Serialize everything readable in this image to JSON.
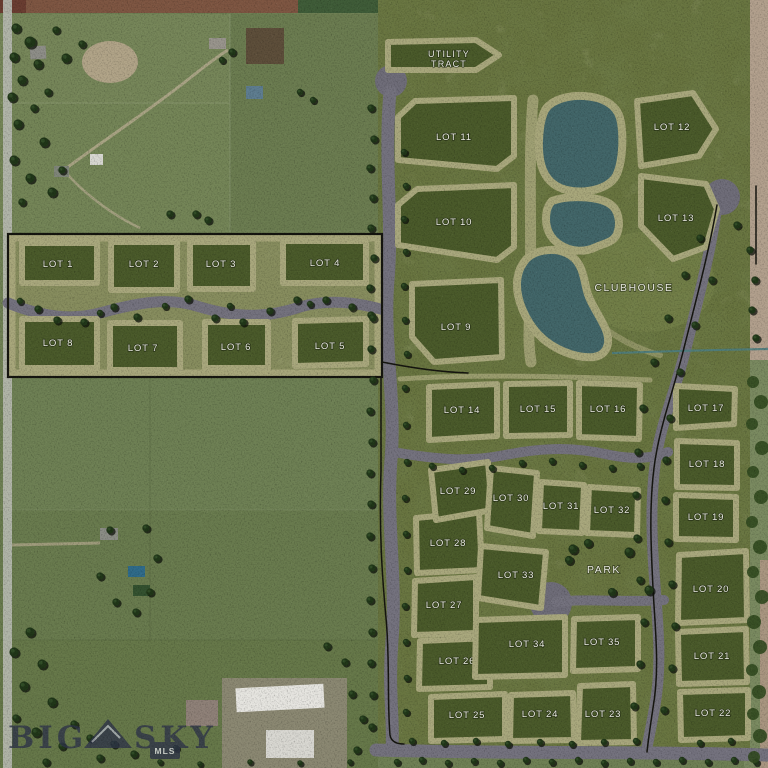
{
  "watermark": {
    "word1": "BIG",
    "word2": "SKY",
    "badge": "MLS"
  },
  "plat": {
    "utility_tract": {
      "line1": "UTILITY",
      "line2": "TRACT"
    },
    "clubhouse_label": "CLUBHOUSE",
    "park_label": "PARK",
    "lots": [
      {
        "id": 1,
        "label": "LOT 1"
      },
      {
        "id": 2,
        "label": "LOT 2"
      },
      {
        "id": 3,
        "label": "LOT 3"
      },
      {
        "id": 4,
        "label": "LOT 4"
      },
      {
        "id": 5,
        "label": "LOT 5"
      },
      {
        "id": 6,
        "label": "LOT 6"
      },
      {
        "id": 7,
        "label": "LOT 7"
      },
      {
        "id": 8,
        "label": "LOT 8"
      },
      {
        "id": 9,
        "label": "LOT 9"
      },
      {
        "id": 10,
        "label": "LOT 10"
      },
      {
        "id": 11,
        "label": "LOT 11"
      },
      {
        "id": 12,
        "label": "LOT 12"
      },
      {
        "id": 13,
        "label": "LOT 13"
      },
      {
        "id": 14,
        "label": "LOT 14"
      },
      {
        "id": 15,
        "label": "LOT 15"
      },
      {
        "id": 16,
        "label": "LOT 16"
      },
      {
        "id": 17,
        "label": "LOT 17"
      },
      {
        "id": 18,
        "label": "LOT 18"
      },
      {
        "id": 19,
        "label": "LOT 19"
      },
      {
        "id": 20,
        "label": "LOT 20"
      },
      {
        "id": 21,
        "label": "LOT 21"
      },
      {
        "id": 22,
        "label": "LOT 22"
      },
      {
        "id": 23,
        "label": "LOT 23"
      },
      {
        "id": 24,
        "label": "LOT 24"
      },
      {
        "id": 25,
        "label": "LOT 25"
      },
      {
        "id": 26,
        "label": "LOT 26"
      },
      {
        "id": 27,
        "label": "LOT 27"
      },
      {
        "id": 28,
        "label": "LOT 28"
      },
      {
        "id": 29,
        "label": "LOT 29"
      },
      {
        "id": 30,
        "label": "LOT 30"
      },
      {
        "id": 31,
        "label": "LOT 31"
      },
      {
        "id": 32,
        "label": "LOT 32"
      },
      {
        "id": 33,
        "label": "LOT 33"
      },
      {
        "id": 34,
        "label": "LOT 34"
      },
      {
        "id": 35,
        "label": "LOT 35"
      }
    ]
  },
  "colors": {
    "plat_green": "#68743f",
    "lot_green": "#4a5a2a",
    "trail_tan": "#a9a87d",
    "road_gray": "#74727e",
    "pond_teal": "#426669",
    "aerial_green": "#6f8054",
    "dirt_tan": "#b2a08d",
    "watermark_navy": "#2e3449",
    "label_white": "#efefe7"
  }
}
